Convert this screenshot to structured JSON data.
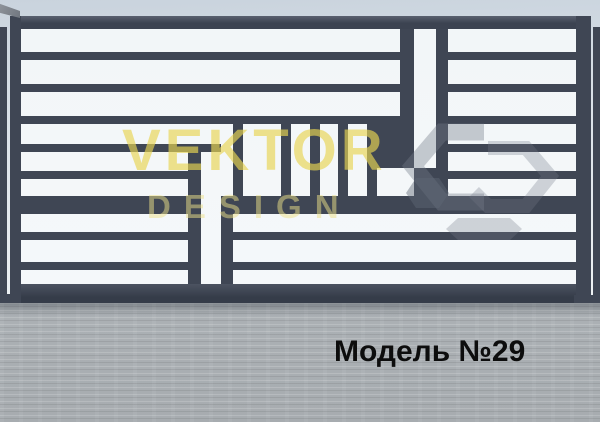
{
  "watermark": {
    "line1": "VEKTOR",
    "line2": "DESIGN",
    "logo_icon": "hexagon-logo-watermark"
  },
  "caption": {
    "text": "Модель №29"
  },
  "colors": {
    "metal_dark": "#3f4654",
    "metal_light": "#5a6170",
    "white_bar": "#f4f7f9",
    "sky_top": "#c9d3dd",
    "sky_bottom": "#eef2f4",
    "floor_gray": "#a7acb0",
    "watermark_yellow": "rgba(232,213,82,0.66)",
    "watermark_yellow_light": "rgba(238,226,136,0.5)",
    "logo_gray": "rgba(116,124,136,0.4)",
    "caption_black": "#0d0d0d"
  },
  "gate": {
    "panel": [
      10,
      16,
      581,
      287
    ],
    "dark_rects": [
      [
        10,
        16,
        581,
        13,
        "hl"
      ],
      [
        10,
        284,
        581,
        19,
        "bt"
      ],
      [
        10,
        16,
        11,
        287
      ],
      [
        576,
        16,
        15,
        287
      ],
      [
        0,
        27,
        7,
        274
      ],
      [
        593,
        27,
        7,
        274
      ],
      [
        0,
        294,
        18,
        10
      ],
      [
        574,
        295,
        26,
        11
      ],
      [
        21,
        52,
        379,
        8
      ],
      [
        448,
        52,
        128,
        8
      ],
      [
        21,
        84,
        379,
        8
      ],
      [
        448,
        84,
        128,
        8
      ],
      [
        21,
        116,
        379,
        8
      ],
      [
        448,
        116,
        128,
        8
      ],
      [
        21,
        144,
        200,
        8
      ],
      [
        436,
        144,
        140,
        8
      ],
      [
        21,
        171,
        167,
        8
      ],
      [
        436,
        171,
        140,
        8
      ],
      [
        21,
        196,
        167,
        18
      ],
      [
        221,
        196,
        355,
        18
      ],
      [
        21,
        232,
        167,
        8
      ],
      [
        233,
        232,
        343,
        8
      ],
      [
        21,
        262,
        167,
        8
      ],
      [
        233,
        262,
        343,
        8
      ],
      [
        400,
        29,
        14,
        139
      ],
      [
        436,
        29,
        12,
        167
      ],
      [
        377,
        116,
        23,
        52
      ],
      [
        414,
        168,
        34,
        28
      ],
      [
        188,
        152,
        13,
        132
      ],
      [
        221,
        196,
        12,
        88
      ],
      [
        233,
        124,
        10,
        72
      ],
      [
        281,
        124,
        10,
        72
      ],
      [
        310,
        124,
        10,
        72
      ],
      [
        338,
        124,
        10,
        72
      ],
      [
        367,
        124,
        10,
        72
      ]
    ]
  }
}
